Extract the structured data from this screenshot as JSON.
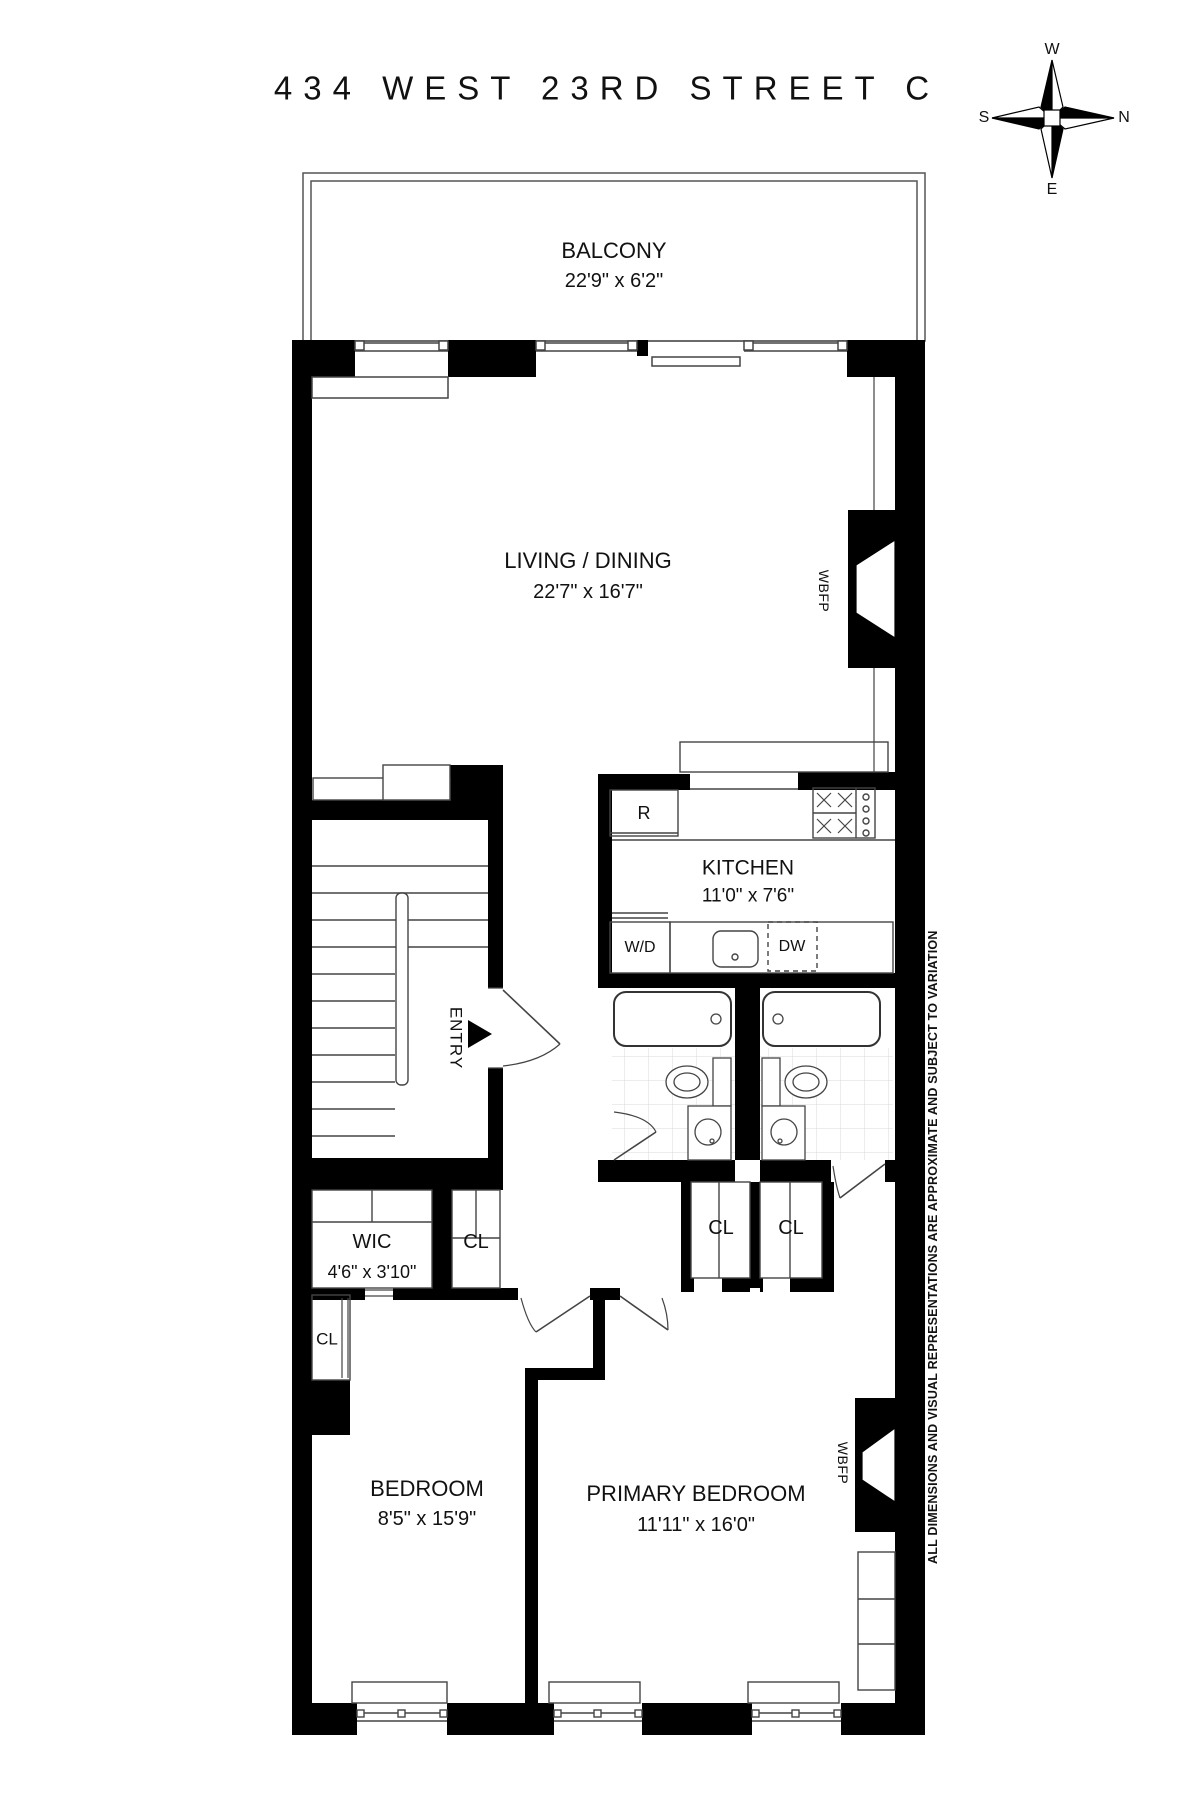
{
  "title": "434 WEST 23RD STREET C",
  "compass": {
    "west": "W",
    "south": "S",
    "north": "N",
    "east": "E"
  },
  "rooms": {
    "balcony": {
      "name": "BALCONY",
      "dims": "22'9\" x 6'2\""
    },
    "living_dining": {
      "name": "LIVING / DINING",
      "dims": "22'7\" x 16'7\""
    },
    "kitchen": {
      "name": "KITCHEN",
      "dims": "11'0\" x 7'6\""
    },
    "wic": {
      "name": "WIC",
      "dims": "4'6\" x 3'10\""
    },
    "bedroom": {
      "name": "BEDROOM",
      "dims": "8'5\" x 15'9\""
    },
    "primary_bedroom": {
      "name": "PRIMARY BEDROOM",
      "dims": "11'11\" x 16'0\""
    }
  },
  "labels": {
    "entry": "ENTRY",
    "fireplace": "WBFP",
    "closet": "CL",
    "refrigerator": "R",
    "washer_dryer": "W/D",
    "dishwasher": "DW"
  },
  "disclaimer": "ALL DIMENSIONS AND VISUAL REPRESENTATIONS ARE APPROXIMATE AND SUBJECT TO VARIATION",
  "colors": {
    "wall": "#000000",
    "line": "#4a4a4a",
    "tile": "#d8d8d8",
    "text": "#111111",
    "background": "#ffffff"
  }
}
